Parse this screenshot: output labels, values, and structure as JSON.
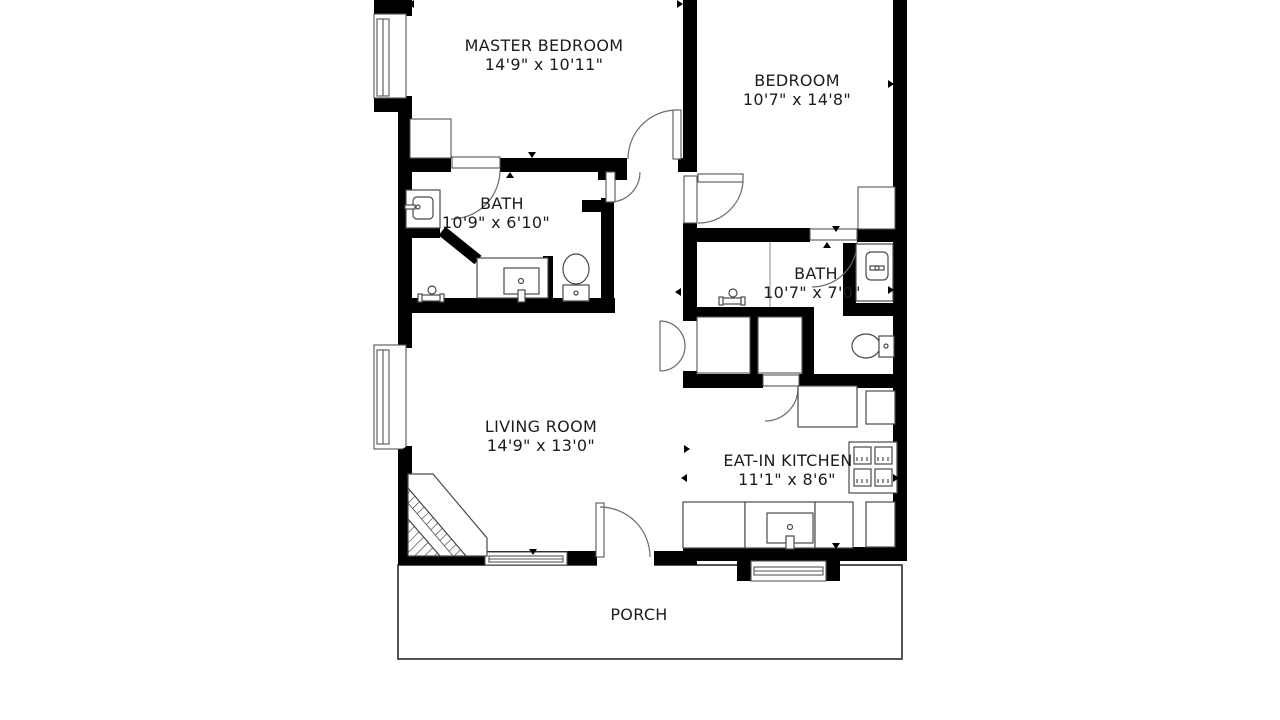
{
  "page_title": "Floor Plan",
  "rooms": [
    {
      "id": "master-bedroom",
      "name": "MASTER BEDROOM",
      "dims": "14'9\" x 10'11\""
    },
    {
      "id": "bedroom",
      "name": "BEDROOM",
      "dims": "10'7\" x 14'8\""
    },
    {
      "id": "bath-master",
      "name": "BATH",
      "dims": "10'9\" x 6'10\""
    },
    {
      "id": "bath-hall",
      "name": "BATH",
      "dims": "10'7\" x 7'0\""
    },
    {
      "id": "living-room",
      "name": "LIVING ROOM",
      "dims": "14'9\" x 13'0\""
    },
    {
      "id": "eat-in-kitchen",
      "name": "EAT-IN KITCHEN",
      "dims": "11'1\" x 8'6\""
    },
    {
      "id": "porch",
      "name": "PORCH",
      "dims": ""
    }
  ],
  "colors": {
    "wall": "#000000",
    "fixture_line": "#4a4a4a",
    "text": "#1c1c1c",
    "background": "#ffffff"
  }
}
